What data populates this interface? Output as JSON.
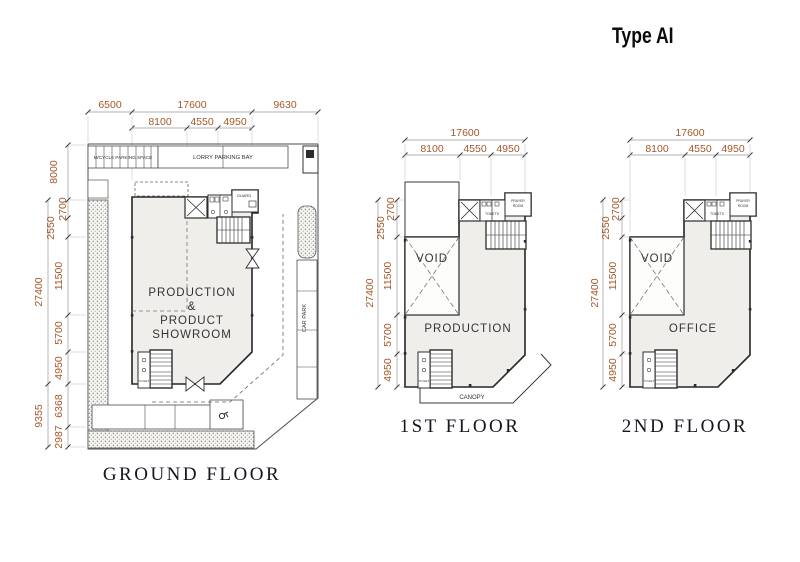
{
  "header": {
    "type_label": "Type AI"
  },
  "colors": {
    "dimension_text": "#a3582a",
    "wall_line": "#262626",
    "plate_fill": "#f0eeeb"
  },
  "ground_floor": {
    "label": "GROUND FLOOR",
    "top_dims": [
      "6500",
      "17600",
      "9630"
    ],
    "top_dims_inner": [
      "8100",
      "4550",
      "4950"
    ],
    "left_total_top": "8000",
    "left_total_mid": "27400",
    "left_total_bottom": "9355",
    "left_dims": [
      "2700",
      "2550",
      "11500",
      "5700",
      "4950",
      "6368",
      "2987"
    ],
    "room_lines": [
      "PRODUCTION",
      "&",
      "PRODUCT",
      "SHOWROOM"
    ],
    "mcycle_label": "M/CYCLE PARKING SPACE",
    "lorry_label": "LORRY PARKING BAY",
    "carpark_label": "CAR PARK",
    "guard_label": "GUARD",
    "toilet_label": "TOILET"
  },
  "first_floor": {
    "label": "1ST FLOOR",
    "top_dim_total": "17600",
    "top_dims_inner": [
      "8100",
      "4550",
      "4950"
    ],
    "left_total": "27400",
    "left_dims": [
      "2700",
      "2550",
      "11500",
      "5700",
      "4950"
    ],
    "void_label": "VOID",
    "room_label": "PRODUCTION",
    "canopy_label": "CANOPY",
    "toilets_label": "TOILETS",
    "prayer_lines": [
      "PRAYER",
      "ROOM"
    ],
    "toilet_label": "TOILET"
  },
  "second_floor": {
    "label": "2ND FLOOR",
    "top_dim_total": "17600",
    "top_dims_inner": [
      "8100",
      "4550",
      "4950"
    ],
    "left_total": "27400",
    "left_dims": [
      "2700",
      "2550",
      "11500",
      "5700",
      "4950"
    ],
    "void_label": "VOID",
    "room_label": "OFFICE",
    "toilets_label": "TOILETS",
    "prayer_lines": [
      "PRAYER",
      "ROOM"
    ],
    "toilet_label": "TOILET"
  }
}
